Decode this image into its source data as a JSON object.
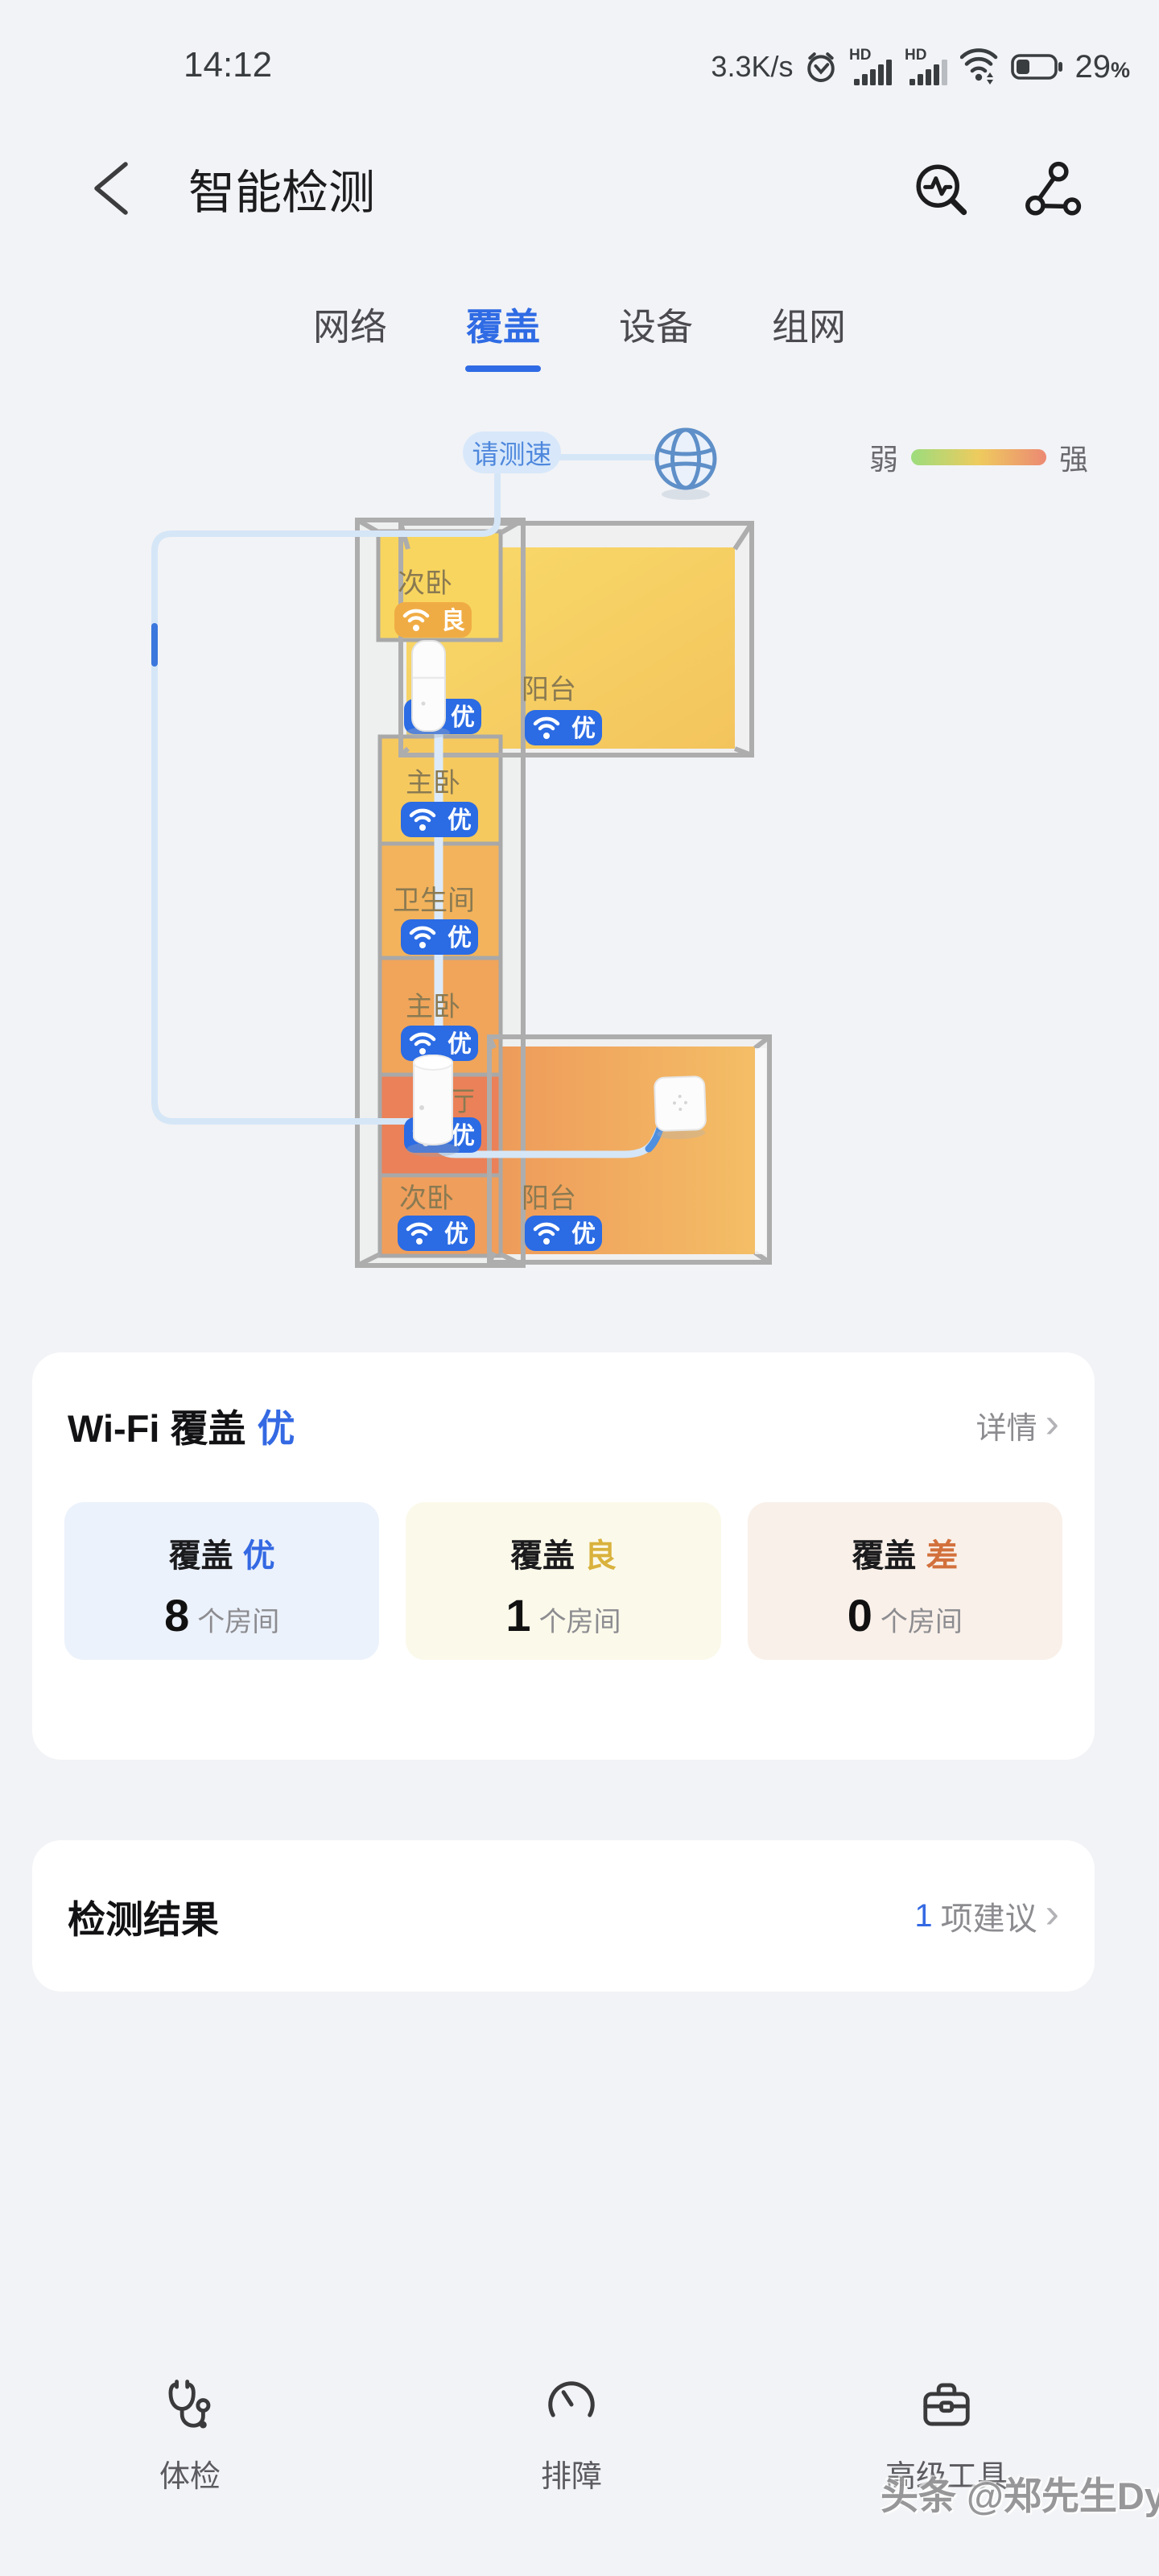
{
  "status_bar": {
    "time": "14:12",
    "net_speed": "3.3K/s",
    "hd_label": "HD",
    "battery_level": "29",
    "battery_suffix": "%"
  },
  "header": {
    "title": "智能检测"
  },
  "tabs": {
    "items": [
      {
        "label": "网络",
        "active": false
      },
      {
        "label": "覆盖",
        "active": true
      },
      {
        "label": "设备",
        "active": false
      },
      {
        "label": "组网",
        "active": false
      }
    ]
  },
  "floorplan": {
    "tooltip": "请测速",
    "legend": {
      "weak": "弱",
      "strong": "强",
      "gradient": [
        "#9CDC7D",
        "#EECB5E",
        "#EC8973"
      ]
    },
    "grade_colors": {
      "excellent": "#2B6BE4",
      "good": "#F0AC44"
    },
    "label_color": "#8A7A52",
    "floors": [
      {
        "rect": [
          505,
          180,
          408,
          250
        ],
        "gradient": "floorTop"
      },
      {
        "rect": [
          612,
          800,
          326,
          258
        ],
        "gradient": "floorBR"
      }
    ],
    "rooms": [
      {
        "name": "次卧",
        "grade": "良",
        "type": "good",
        "rect": [
          470,
          160,
          152,
          135
        ],
        "fill": "#F8D55F",
        "label": [
          494,
          236
        ],
        "badge": [
          490,
          248
        ]
      },
      {
        "name": "厅",
        "grade": "优",
        "type": "exc",
        "rect": null,
        "fill": null,
        "label": [
          514,
          354
        ],
        "badge": [
          502,
          368
        ]
      },
      {
        "name": "阳台",
        "grade": "优",
        "type": "exc",
        "rect": null,
        "fill": null,
        "label": [
          648,
          368
        ],
        "badge": [
          652,
          382
        ]
      },
      {
        "name": "主卧",
        "grade": "优",
        "type": "exc",
        "rect": [
          472,
          415,
          150,
          133
        ],
        "fill": "#F6C95F",
        "label": [
          504,
          484
        ],
        "badge": [
          498,
          496
        ]
      },
      {
        "name": "卫生间",
        "grade": "优",
        "type": "exc",
        "rect": [
          472,
          548,
          150,
          142
        ],
        "fill": "#F3B35C",
        "label": [
          488,
          630
        ],
        "badge": [
          498,
          642
        ]
      },
      {
        "name": "主卧",
        "grade": "优",
        "type": "exc",
        "rect": [
          472,
          690,
          150,
          145
        ],
        "fill": "#F0A55A",
        "label": [
          504,
          762
        ],
        "badge": [
          498,
          774
        ]
      },
      {
        "name": "厅",
        "grade": "优",
        "type": "exc",
        "rect": [
          472,
          835,
          150,
          125
        ],
        "fill": "#EB8158",
        "label": [
          556,
          880
        ],
        "badge": [
          502,
          888
        ]
      },
      {
        "name": "次卧",
        "grade": "优",
        "type": "exc",
        "rect": [
          472,
          960,
          150,
          100
        ],
        "fill": "#EF9E5C",
        "label": [
          496,
          1000
        ],
        "badge": [
          494,
          1010
        ]
      },
      {
        "name": "阳台",
        "grade": "优",
        "type": "exc",
        "rect": null,
        "fill": null,
        "label": [
          648,
          1000
        ],
        "badge": [
          652,
          1010
        ]
      }
    ]
  },
  "coverage_card": {
    "title": "Wi-Fi 覆盖",
    "grade": "优",
    "details_label": "详情",
    "stats": [
      {
        "label": "覆盖",
        "grade": "优",
        "type": "exc",
        "count": "8",
        "unit": "个房间"
      },
      {
        "label": "覆盖",
        "grade": "良",
        "type": "good",
        "count": "1",
        "unit": "个房间"
      },
      {
        "label": "覆盖",
        "grade": "差",
        "type": "poor",
        "count": "0",
        "unit": "个房间"
      }
    ]
  },
  "result_card": {
    "title": "检测结果",
    "count": "1",
    "suggestion_label": "项建议"
  },
  "bottom_nav": {
    "items": [
      {
        "label": "体检",
        "icon": "stethoscope-icon"
      },
      {
        "label": "排障",
        "icon": "gauge-icon"
      },
      {
        "label": "高级工具",
        "icon": "toolbox-icon"
      }
    ]
  },
  "watermark": "头条 @郑先生Dy"
}
